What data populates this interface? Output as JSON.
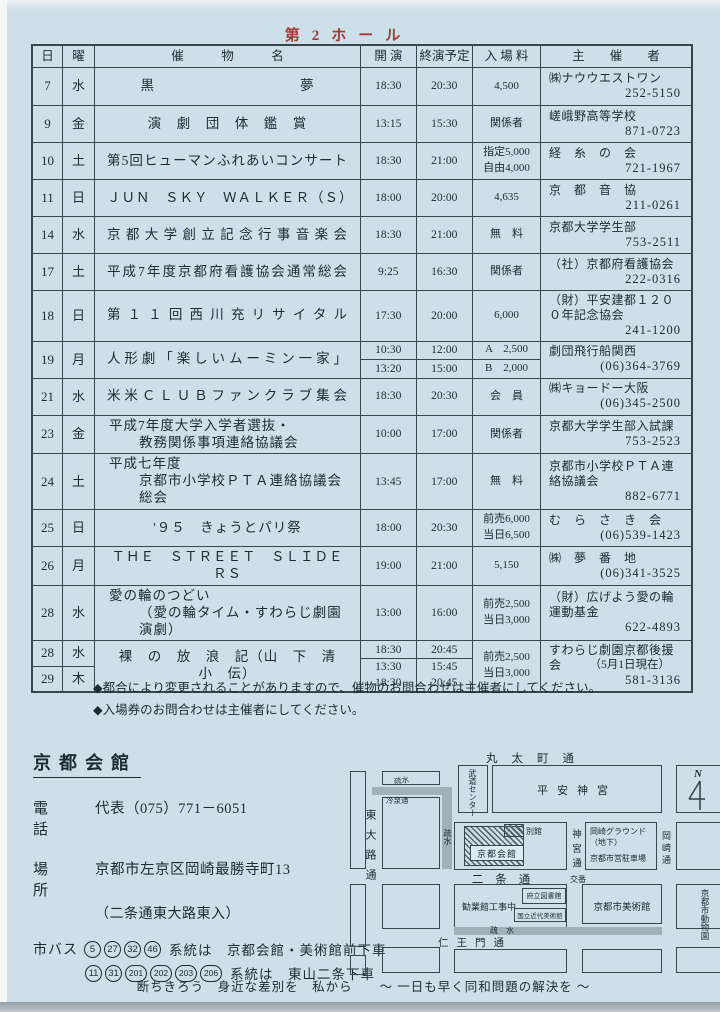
{
  "page": {
    "hall_title": "第2ホール",
    "as_of": "（5月1日現在）",
    "notes": [
      "◆都合により変更されることがありますので、催物のお問合わせは主催者にしてください。",
      "◆入場券のお問合わせは主催者にしてください。"
    ],
    "slogan": "断ちきろう　身近な差別を　私から　　～ 一日も早く同和問題の解決を ～"
  },
  "table": {
    "headers": {
      "day": "日",
      "weekday": "曜",
      "event": "催　　　物　　　名",
      "start": "開 演",
      "end": "終演予定",
      "admission": "入 場 料",
      "organizer": "主　　催　　者"
    },
    "rows": [
      {
        "days": [
          [
            "7",
            "水"
          ]
        ],
        "title": [
          {
            "t": "黒　　　　　　　　　　夢",
            "c": "c"
          }
        ],
        "times": [
          [
            [
              "18:30",
              "20:30"
            ]
          ]
        ],
        "fees": [
          [
            "4,500"
          ]
        ],
        "org": "㈱ナウウエストワン",
        "tel": "252-5150"
      },
      {
        "days": [
          [
            "9",
            "金"
          ]
        ],
        "title": [
          {
            "t": "演　劇　団　体　鑑　賞",
            "c": "c"
          }
        ],
        "times": [
          [
            [
              "13:15",
              "15:30"
            ]
          ]
        ],
        "fees": [
          [
            "関係者"
          ]
        ],
        "org": "嵯峨野高等学校",
        "tel": "871-0723"
      },
      {
        "days": [
          [
            "10",
            "土"
          ]
        ],
        "title": [
          {
            "t": "第5回ヒューマンふれあいコンサート",
            "c": "j"
          }
        ],
        "times": [
          [
            [
              "18:30",
              "21:00"
            ]
          ]
        ],
        "fees": [
          [
            "指定5,000",
            "自由4,000"
          ]
        ],
        "org": "経　糸　の　会",
        "tel": "721-1967"
      },
      {
        "days": [
          [
            "11",
            "日"
          ]
        ],
        "title": [
          {
            "t": "ＪＵＮ　ＳＫＹ　ＷＡＬＫＥＲ（Ｓ）",
            "c": "c"
          }
        ],
        "times": [
          [
            [
              "18:00",
              "20:00"
            ]
          ]
        ],
        "fees": [
          [
            "4,635"
          ]
        ],
        "org": "京　都　音　協",
        "tel": "211-0261"
      },
      {
        "days": [
          [
            "14",
            "水"
          ]
        ],
        "title": [
          {
            "t": "京都大学創立記念行事音楽会",
            "c": "j"
          }
        ],
        "times": [
          [
            [
              "18:30",
              "21:00"
            ]
          ]
        ],
        "fees": [
          [
            "無　料"
          ]
        ],
        "org": "京都大学学生部",
        "tel": "753-2511"
      },
      {
        "days": [
          [
            "17",
            "土"
          ]
        ],
        "title": [
          {
            "t": "平成7年度京都府看護協会通常総会",
            "c": "j"
          }
        ],
        "times": [
          [
            [
              "9:25",
              "16:30"
            ]
          ]
        ],
        "fees": [
          [
            "関係者"
          ]
        ],
        "org": "（社）京都府看護協会",
        "tel": "222-0316"
      },
      {
        "days": [
          [
            "18",
            "日"
          ]
        ],
        "title": [
          {
            "t": "第１１回西川充リサイタル",
            "c": "j"
          }
        ],
        "times": [
          [
            [
              "17:30",
              "20:00"
            ]
          ]
        ],
        "fees": [
          [
            "6,000"
          ]
        ],
        "org": "（財）平安建都１２００年記念協会",
        "tel": "241-1200"
      },
      {
        "days": [
          [
            "19",
            "月"
          ]
        ],
        "title": [
          {
            "t": "人形劇「楽しいムーミン一家」",
            "c": "j"
          }
        ],
        "times": [
          [
            [
              "10:30",
              "12:00"
            ]
          ],
          [
            [
              "13:20",
              "15:00"
            ]
          ]
        ],
        "fees": [
          [
            "A　2,500"
          ],
          [
            "B　2,000"
          ]
        ],
        "org": "劇団飛行船関西",
        "tel": "(06)364-3769"
      },
      {
        "days": [
          [
            "21",
            "水"
          ]
        ],
        "title": [
          {
            "t": "米米ＣＬＵＢファンクラブ集会",
            "c": "j"
          }
        ],
        "times": [
          [
            [
              "18:30",
              "20:30"
            ]
          ]
        ],
        "fees": [
          [
            "会　員"
          ]
        ],
        "org": "㈱キョードー大阪",
        "tel": "(06)345-2500"
      },
      {
        "days": [
          [
            "23",
            "金"
          ]
        ],
        "title": [
          {
            "t": "平成7年度大学入学者選抜・",
            "c": "l"
          },
          {
            "t": "教務関係事項連絡協議会",
            "c": "i"
          }
        ],
        "times": [
          [
            [
              "10:00",
              "17:00"
            ]
          ]
        ],
        "fees": [
          [
            "関係者"
          ]
        ],
        "org": "京都大学学生部入試課",
        "tel": "753-2523"
      },
      {
        "days": [
          [
            "24",
            "土"
          ]
        ],
        "title": [
          {
            "t": "平成七年度",
            "c": "l"
          },
          {
            "t": "京都市小学校ＰＴＡ連絡協議会総会",
            "c": "i"
          }
        ],
        "times": [
          [
            [
              "13:45",
              "17:00"
            ]
          ]
        ],
        "fees": [
          [
            "無　料"
          ]
        ],
        "org": "京都市小学校ＰＴＡ連絡協議会",
        "tel": "882-6771"
      },
      {
        "days": [
          [
            "25",
            "日"
          ]
        ],
        "title": [
          {
            "t": "'９５　きょうとパリ祭",
            "c": "c"
          }
        ],
        "times": [
          [
            [
              "18:00",
              "20:30"
            ]
          ]
        ],
        "fees": [
          [
            "前売6,000",
            "当日6,500"
          ]
        ],
        "org": "む　ら　さ　き　会",
        "tel": "(06)539-1423"
      },
      {
        "days": [
          [
            "26",
            "月"
          ]
        ],
        "title": [
          {
            "t": "ＴＨＥ　ＳＴＲＥＥＴ　ＳＬＩＤＥＲＳ",
            "c": "c"
          }
        ],
        "times": [
          [
            [
              "19:00",
              "21:00"
            ]
          ]
        ],
        "fees": [
          [
            "5,150"
          ]
        ],
        "org": "㈱　夢　番　地",
        "tel": "(06)341-3525"
      },
      {
        "days": [
          [
            "28",
            "水"
          ]
        ],
        "title": [
          {
            "t": "愛の輪のつどい",
            "c": "l"
          },
          {
            "t": "（愛の輪タイム・すわらじ劇園演劇）",
            "c": "i"
          }
        ],
        "times": [
          [
            [
              "13:00",
              "16:00"
            ]
          ]
        ],
        "fees": [
          [
            "前売2,500",
            "当日3,000"
          ]
        ],
        "org": "（財）広げよう愛の輪運動基金",
        "tel": "622-4893"
      },
      {
        "days": [
          [
            "28",
            "水"
          ],
          [
            "29",
            "木"
          ]
        ],
        "title": [
          {
            "t": "裸　の　放　浪　記（山　下　清　小　伝）",
            "c": "c"
          }
        ],
        "times": [
          [
            [
              "18:30",
              "20:45"
            ]
          ],
          [
            [
              "13:30",
              "15:45"
            ],
            [
              "18:30",
              "20:45"
            ]
          ]
        ],
        "fees": [
          [
            "前売2,500",
            "当日3,000"
          ]
        ],
        "org": "すわらじ劇園京都後援会",
        "tel": "581-3136"
      }
    ]
  },
  "venue": {
    "name": "京都会館",
    "tel_label": "電　話",
    "tel": "代表（075）771－6051",
    "place_label": "場　所",
    "address": "京都市左京区岡崎最勝寺町13",
    "address2": "（二条通東大路東入）",
    "bus_label": "市バス",
    "bus1_routes": [
      "5",
      "27",
      "32",
      "46"
    ],
    "bus1_text": "系統は　京都会館・美術館前下車",
    "bus2_routes": [
      "11",
      "31",
      "201",
      "202",
      "203",
      "206"
    ],
    "bus2_text": "系統は　東山二条下車"
  },
  "map": {
    "streets": {
      "marutamachi": "丸太町通",
      "nijo": "二条通",
      "niomon": "仁王門通",
      "higashioji": "東大路通",
      "jingu": "神宮通",
      "okazaki": "岡崎通",
      "reisen": "冷泉通"
    },
    "water": {
      "sosui_top": "疏水",
      "sosui_side": "疏水",
      "sosui_bottom": "疏　水"
    },
    "places": {
      "budo": "武道センター",
      "heian": "平安神宮",
      "kaikan": "京都会館",
      "bekkan": "別館",
      "ground": "岡崎グラウンド",
      "ground2": "（地下）",
      "parking": "京都市営駐車場",
      "koban": "交番",
      "kangyokan": "勧業館工事中",
      "library": "府立図書館",
      "momak": "国立近代美術館",
      "museum": "京都市美術館",
      "zoo": "京都市動物園"
    },
    "compass": "N"
  }
}
